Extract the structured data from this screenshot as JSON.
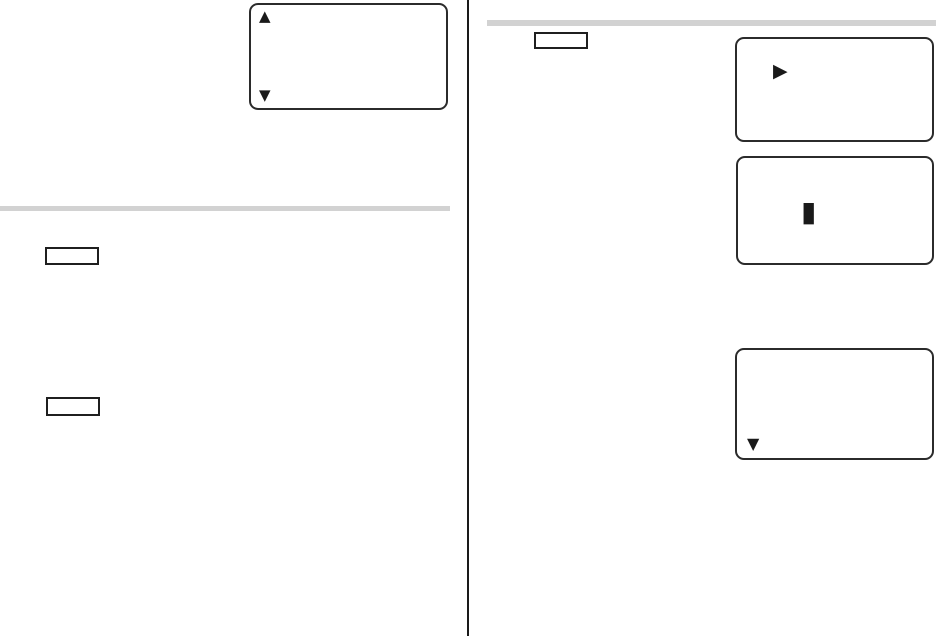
{
  "page": {
    "background": "#ffffff",
    "ink_color": "#1a1a1a",
    "rule_color": "#d2d2d2",
    "lcd_border_color": "#2b2b2b"
  },
  "left_column": {
    "lcd_display": {
      "up_arrow_icon": "▲",
      "down_arrow_icon": "▼"
    },
    "note_box_1": {
      "text": ""
    },
    "note_box_2": {
      "text": ""
    }
  },
  "right_column": {
    "note_box": {
      "text": ""
    },
    "lcd_display_1": {
      "play_arrow_icon": "▶"
    },
    "lcd_display_2": {
      "cursor_icon": "▮"
    },
    "lcd_display_3": {
      "down_arrow_icon": "▼"
    }
  }
}
